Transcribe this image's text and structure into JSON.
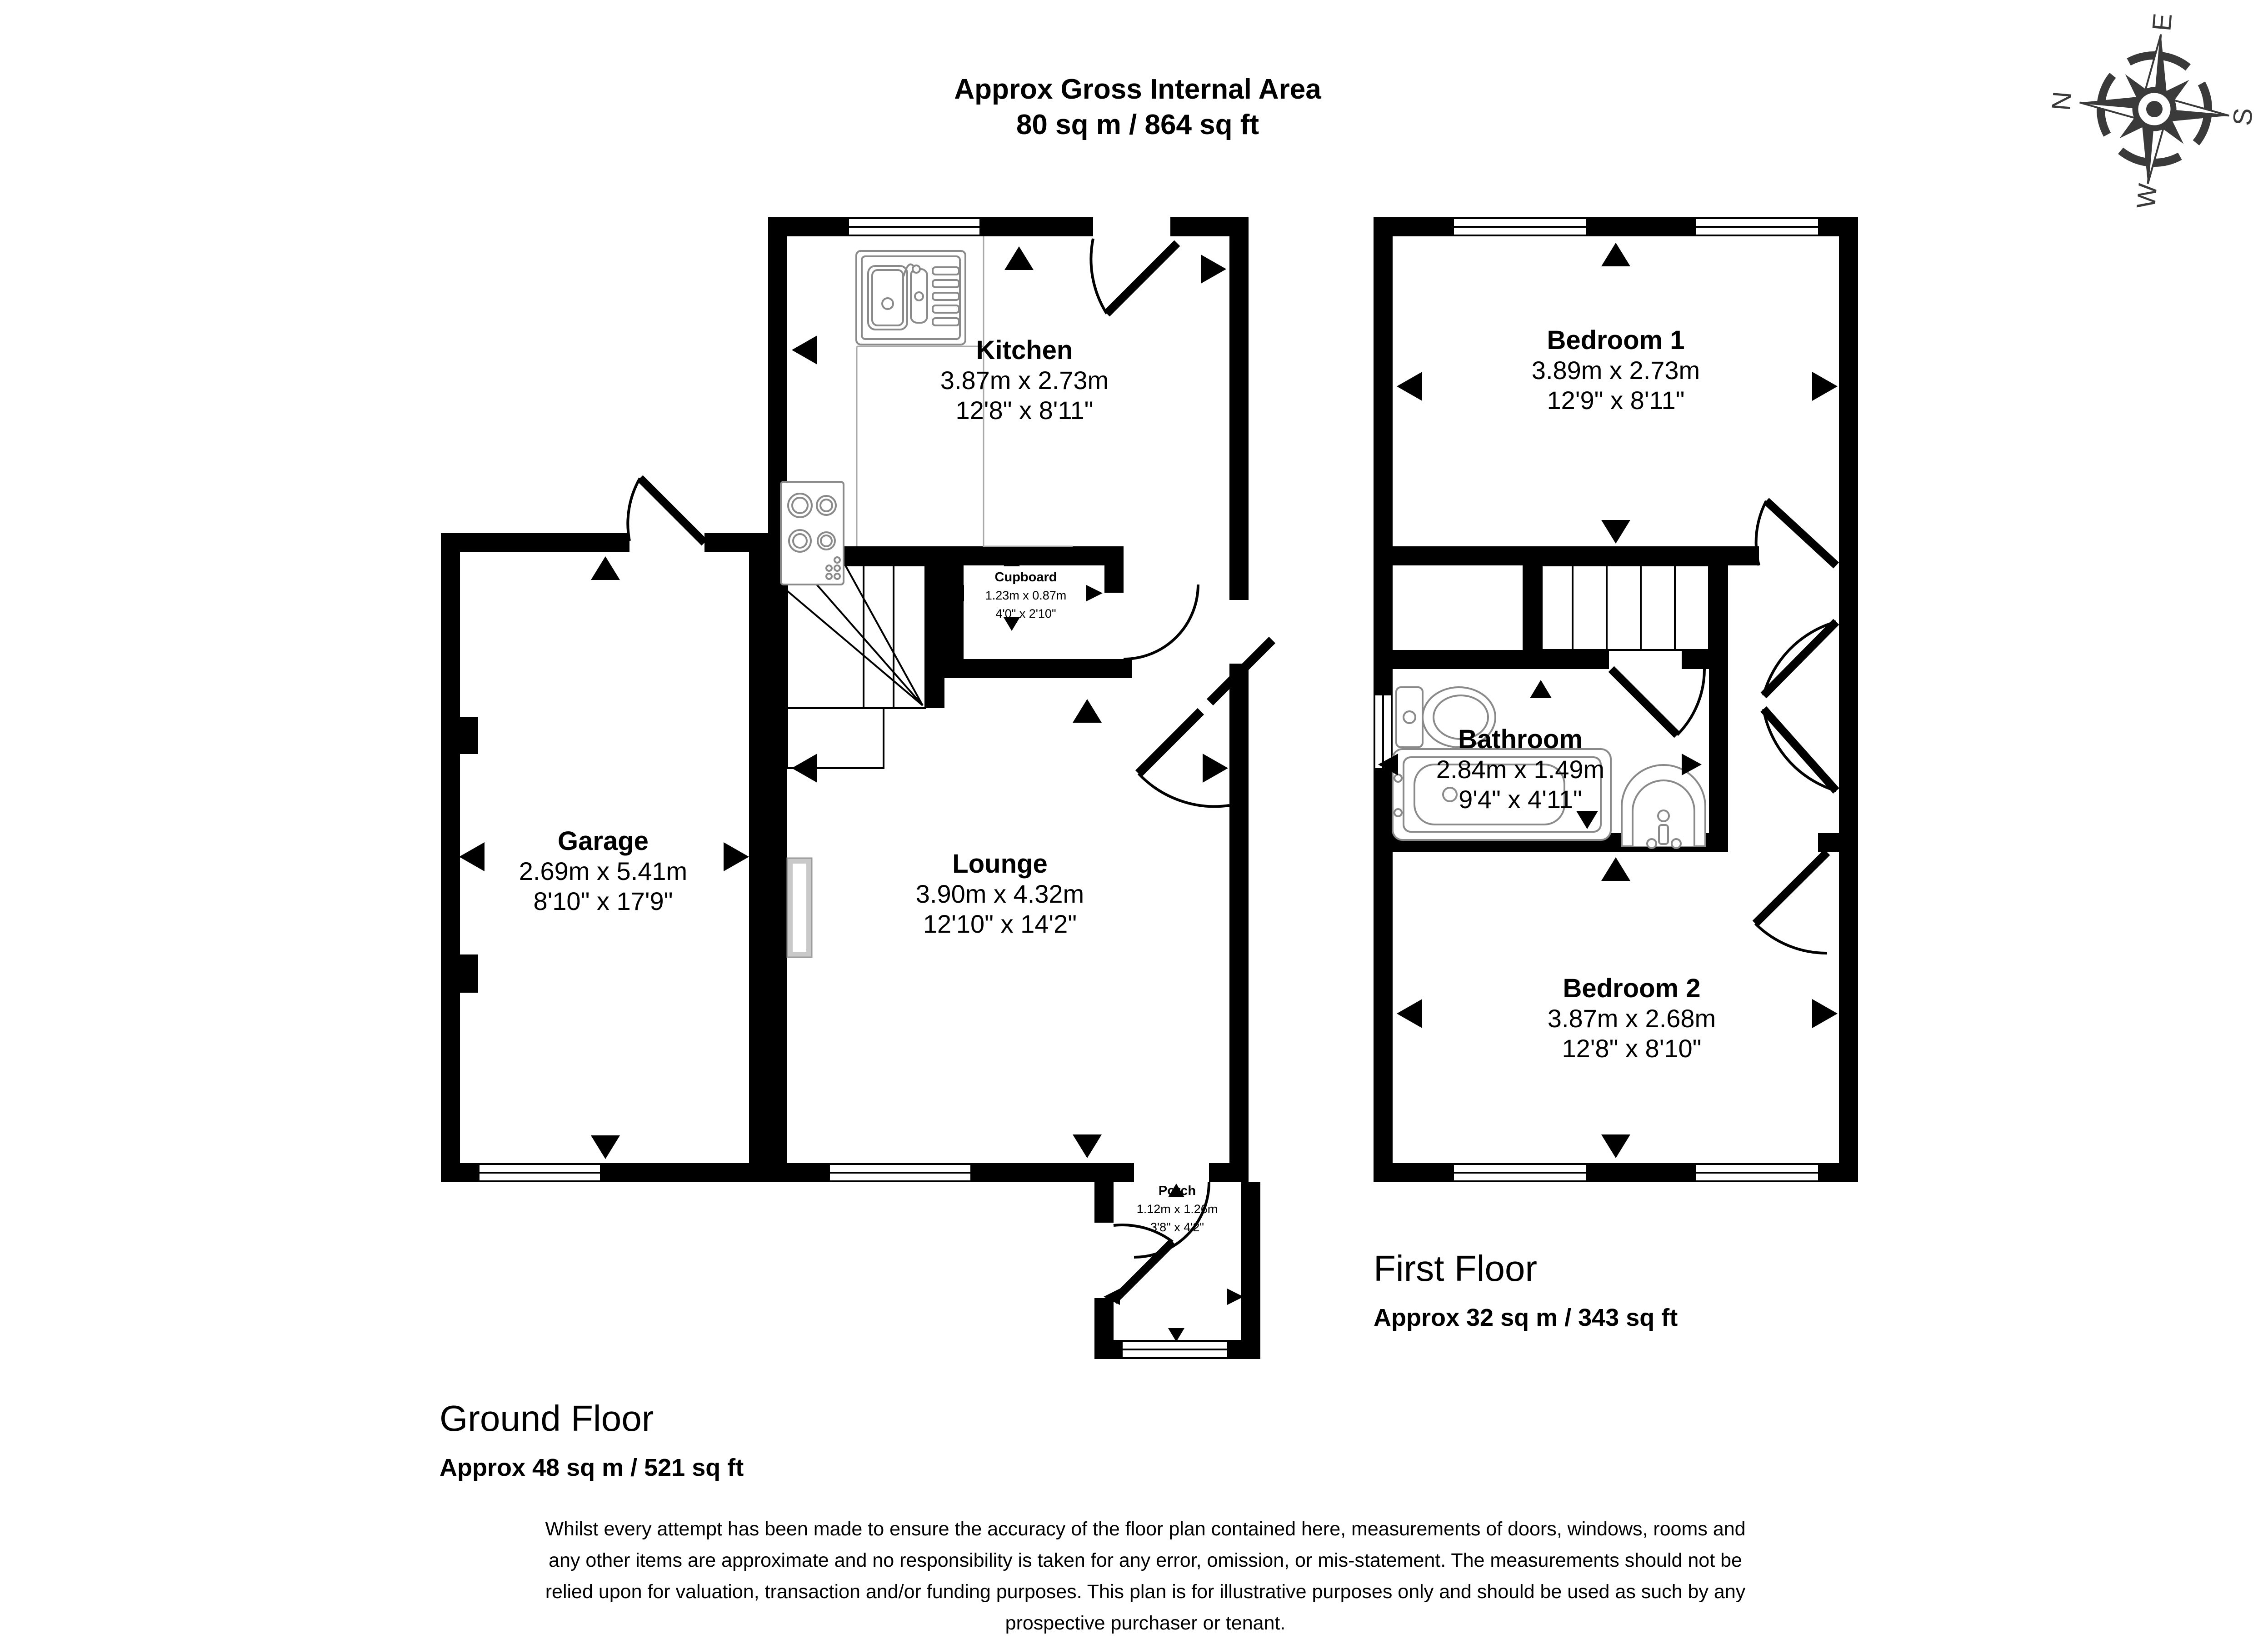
{
  "title": {
    "line1": "Approx Gross Internal Area",
    "line2": "80 sq m / 864 sq ft"
  },
  "compass": {
    "n": "N",
    "e": "E",
    "s": "S",
    "w": "W"
  },
  "floors": {
    "ground": {
      "name": "Ground Floor",
      "area": "Approx 48 sq m / 521 sq ft"
    },
    "first": {
      "name": "First Floor",
      "area": "Approx 32 sq m / 343 sq ft"
    }
  },
  "rooms": {
    "kitchen": {
      "name": "Kitchen",
      "metric": "3.87m x 2.73m",
      "imperial": "12'8\" x 8'11\""
    },
    "garage": {
      "name": "Garage",
      "metric": "2.69m x 5.41m",
      "imperial": "8'10\" x 17'9\""
    },
    "lounge": {
      "name": "Lounge",
      "metric": "3.90m x 4.32m",
      "imperial": "12'10\" x 14'2\""
    },
    "cupboard": {
      "name_line1": "Kitchen understairs",
      "name_line2": "Cupboard",
      "metric": "1.23m x 0.87m",
      "imperial": "4'0\" x 2'10\""
    },
    "porch": {
      "name": "Porch",
      "metric": "1.12m x 1.26m",
      "imperial": "3'8\" x 4'2\""
    },
    "bedroom1": {
      "name": "Bedroom 1",
      "metric": "3.89m x 2.73m",
      "imperial": "12'9\" x 8'11\""
    },
    "bathroom": {
      "name": "Bathroom",
      "metric": "2.84m x 1.49m",
      "imperial": "9'4\" x 4'11\""
    },
    "bedroom2": {
      "name": "Bedroom 2",
      "metric": "3.87m x 2.68m",
      "imperial": "12'8\" x 8'10\""
    }
  },
  "disclaimer": {
    "line1": "Whilst every attempt has been made to ensure the accuracy of the floor plan contained here, measurements of doors, windows, rooms and",
    "line2": "any other items are approximate and no responsibility is taken for any error, omission, or mis-statement. The measurements should not be",
    "line3": "relied upon for valuation, transaction and/or funding purposes. This plan is for illustrative purposes only and should be used as such by any",
    "line4": "prospective purchaser or tenant."
  },
  "colors": {
    "wall": "#000000",
    "fixture": "#8a8a8a",
    "radiator": "#c9c9c9"
  }
}
